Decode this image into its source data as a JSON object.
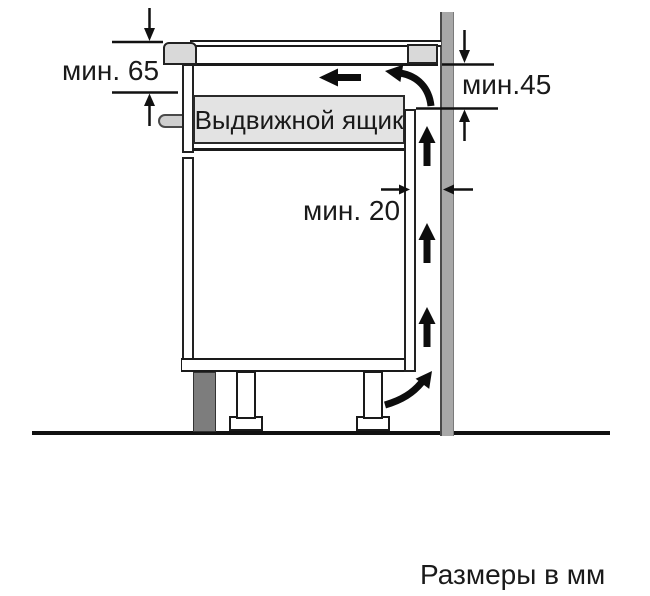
{
  "diagram": {
    "type": "appliance-installation-side-view",
    "labels": {
      "drawer": "Выдвижной ящик",
      "min_top_clearance": "мин. 65",
      "min_rear_clearance": "мин.45",
      "min_wall_gap": "мин. 20",
      "units_note": "Размеры в мм"
    },
    "colors": {
      "background": "#ffffff",
      "line": "#1a1a1a",
      "wall": "#a8a8a8",
      "plinth": "#7d7d7d",
      "hob_trim": "#d9d9d9",
      "drawer_fill": "#e3e3e3"
    }
  }
}
